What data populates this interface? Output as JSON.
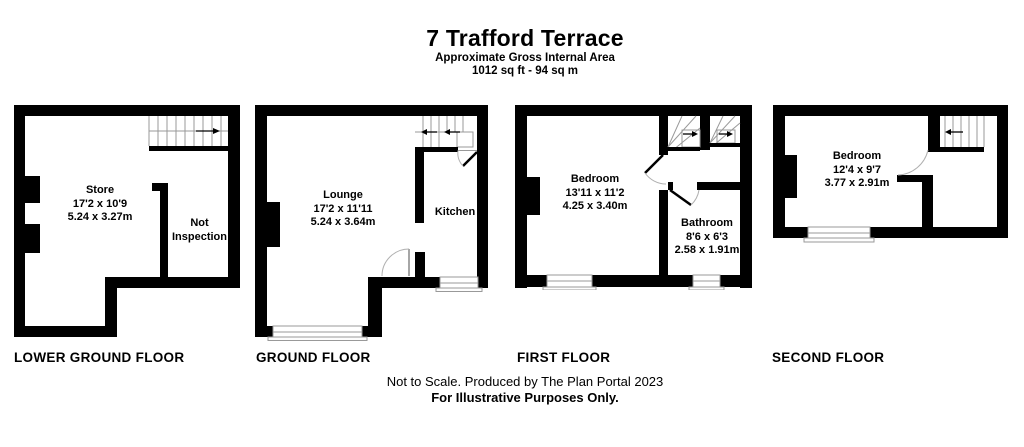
{
  "header": {
    "title": "7 Trafford Terrace",
    "subtitle": "Approximate Gross Internal Area",
    "area": "1012 sq ft - 94 sq m"
  },
  "floors": [
    {
      "label": "LOWER GROUND FLOOR",
      "rooms": [
        {
          "name": "Store",
          "imperial": "17'2 x 10'9",
          "metric": "5.24 x 3.27m"
        },
        {
          "name": "Not Inspection"
        }
      ]
    },
    {
      "label": "GROUND FLOOR",
      "rooms": [
        {
          "name": "Lounge",
          "imperial": "17'2 x 11'11",
          "metric": "5.24 x 3.64m"
        },
        {
          "name": "Kitchen"
        }
      ]
    },
    {
      "label": "FIRST FLOOR",
      "rooms": [
        {
          "name": "Bedroom",
          "imperial": "13'11 x 11'2",
          "metric": "4.25 x 3.40m"
        },
        {
          "name": "Bathroom",
          "imperial": "8'6 x 6'3",
          "metric": "2.58 x 1.91m"
        }
      ]
    },
    {
      "label": "SECOND FLOOR",
      "rooms": [
        {
          "name": "Bedroom",
          "imperial": "12'4 x 9'7",
          "metric": "3.77 x 2.91m"
        }
      ]
    }
  ],
  "footer": {
    "line1": "Not to Scale. Produced by The Plan Portal 2023",
    "line2": "For Illustrative Purposes Only."
  },
  "colors": {
    "wall": "#000000",
    "background": "#ffffff",
    "stair_line": "#999999",
    "door_arc": "#b0b0b0"
  }
}
